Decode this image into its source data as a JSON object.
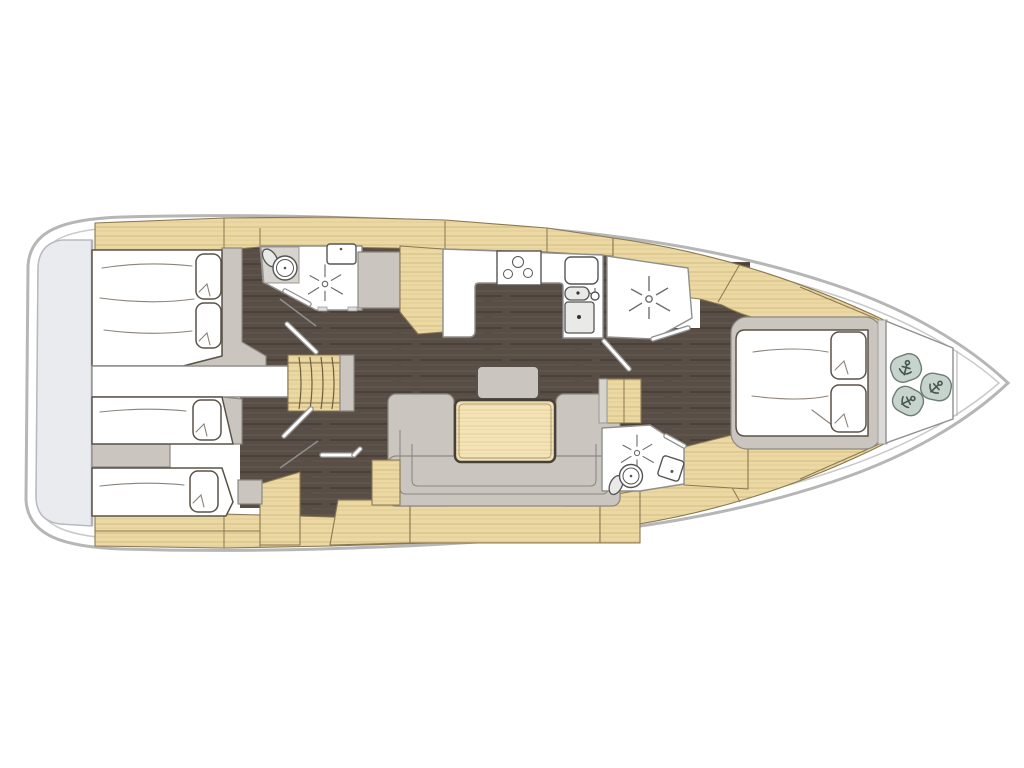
{
  "title": "sailing-yacht-interior-floor-plan",
  "colors": {
    "hull_outline": "#b6b6b6",
    "hull_inner": "#c9c9c9",
    "platform": "#e9ebee",
    "platform_edge": "#b6bac0",
    "floor_base": "#584e45",
    "wood_base": "#ecd8a3",
    "wood_edge": "#8a7850",
    "table_base": "#f4e3b4",
    "upholstery": "#cac6bf",
    "upholstery_edge": "#8d8982",
    "linen": "#ffffff",
    "line_dark": "#5a5248",
    "wall": "#8f8f8f",
    "fixture": "#555555",
    "blob": "#c7d3cd",
    "blob_edge": "#6e7c76",
    "anchor_ink": "#47564f"
  },
  "icons": {
    "shower_spray": "radiating-spray-star",
    "anchor": "anchor-glyph",
    "stove_burners": 3,
    "toilet": "round-bowl-with-tank",
    "sink": "basin-with-tap-dot"
  },
  "rooms": [
    {
      "name": "swim-platform",
      "side": "stern"
    },
    {
      "name": "aft-cabin-port",
      "berth": "double",
      "pillows": 2
    },
    {
      "name": "aft-cabin-starboard",
      "berths": 2,
      "pillows": 2
    },
    {
      "name": "aft-head",
      "fixtures": [
        "toilet",
        "sink",
        "shower"
      ]
    },
    {
      "name": "companionway-stairs",
      "steps": 5
    },
    {
      "name": "galley",
      "fixtures": [
        "stove-3-burner",
        "double-sink",
        "fridge"
      ]
    },
    {
      "name": "salon",
      "furniture": [
        "u-settee",
        "wood-table",
        "stool"
      ]
    },
    {
      "name": "mid-shower-room",
      "fixtures": [
        "shower"
      ]
    },
    {
      "name": "forward-head",
      "fixtures": [
        "toilet",
        "sink",
        "shower"
      ]
    },
    {
      "name": "owners-cabin-bow",
      "berth": "island-double",
      "pillows": 2
    },
    {
      "name": "bow-stowage",
      "bags_with_anchor_mark": 3
    }
  ]
}
